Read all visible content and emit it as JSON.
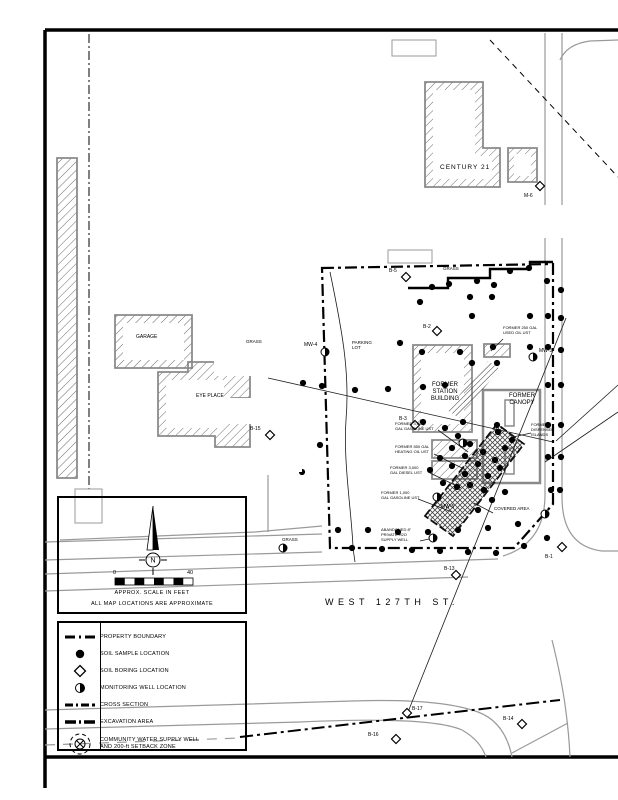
{
  "map": {
    "street_label": "WEST 127TH ST.",
    "labels": [
      {
        "n": "century21-label",
        "t": "CENTURY 21",
        "x": 440,
        "y": 164,
        "fs": 6.5,
        "ls": 1
      },
      {
        "n": "garage-label",
        "t": "GARAGE",
        "x": 136,
        "y": 334,
        "fs": 5
      },
      {
        "n": "grass-label-1",
        "t": "GRASS",
        "x": 246,
        "y": 339,
        "fs": 4.5
      },
      {
        "n": "grass-label-2",
        "t": "GRASS",
        "x": 443,
        "y": 266,
        "fs": 4.5
      },
      {
        "n": "grass-label-3",
        "t": "GRASS",
        "x": 282,
        "y": 537,
        "fs": 4.5
      },
      {
        "n": "parking-lot-label",
        "t": "PARKING\nLOT",
        "x": 352,
        "y": 340,
        "fs": 4.5
      },
      {
        "n": "eyeplace-label",
        "t": "EYE PLACE",
        "x": 196,
        "y": 393,
        "fs": 5
      },
      {
        "n": "former-station-label",
        "t": "FORMER\nSTATION\nBUILDING",
        "x": 423,
        "y": 382,
        "fs": 6,
        "w": 44,
        "ctr": true
      },
      {
        "n": "former-canopy-label",
        "t": "FORMER\nCANOPY",
        "x": 500,
        "y": 393,
        "fs": 6,
        "w": 44,
        "ctr": true
      },
      {
        "n": "dispenser-islands-label",
        "t": "FORMER\nDISPENSER\nISLANDS",
        "x": 531,
        "y": 423,
        "fs": 4
      },
      {
        "n": "ust-3000-gasoline-label",
        "t": "FORMER 3,000\nGAL GASOLINE UST",
        "x": 395,
        "y": 422,
        "fs": 4
      },
      {
        "n": "ust-550-heating-label",
        "t": "FORMER 550 GAL\nHEATING OIL UST",
        "x": 395,
        "y": 445,
        "fs": 4
      },
      {
        "n": "ust-3000-diesel-label",
        "t": "FORMER 3,000\nGAL DIESEL UST",
        "x": 390,
        "y": 466,
        "fs": 4
      },
      {
        "n": "ust-1000-gasoline-label",
        "t": "FORMER 1,000\nGAL GASOLINE UST",
        "x": 381,
        "y": 491,
        "fs": 4
      },
      {
        "n": "ust-250-used-oil-label",
        "t": "FORMER 250 GAL\nUSED OIL UST",
        "x": 503,
        "y": 326,
        "fs": 4
      },
      {
        "n": "abandoned-well-label",
        "t": "ABANDONED 8\"\nPRIVATE H2O\nSUPPLY WELL",
        "x": 381,
        "y": 528,
        "fs": 4
      },
      {
        "n": "covered-area-label",
        "t": "COVERED AREA",
        "x": 494,
        "y": 506,
        "fs": 4.5
      },
      {
        "n": "street-label",
        "t": "WEST 127TH ST.",
        "x": 325,
        "y": 597,
        "fs": 9,
        "ls": 4.5
      }
    ],
    "point_labels": [
      {
        "t": "B-5",
        "x": 389,
        "y": 272
      },
      {
        "t": "M-6",
        "x": 524,
        "y": 197
      },
      {
        "t": "B-15",
        "x": 250,
        "y": 430
      },
      {
        "t": "B-13",
        "x": 444,
        "y": 570
      },
      {
        "t": "B-17",
        "x": 412,
        "y": 710
      },
      {
        "t": "B-16",
        "x": 368,
        "y": 736
      },
      {
        "t": "B-14",
        "x": 503,
        "y": 720
      },
      {
        "t": "MW-4",
        "x": 304,
        "y": 346
      },
      {
        "t": "MW-3",
        "x": 539,
        "y": 352
      },
      {
        "t": "MW-5",
        "x": 441,
        "y": 508
      },
      {
        "t": "B-2",
        "x": 423,
        "y": 328
      },
      {
        "t": "B-3",
        "x": 399,
        "y": 420
      },
      {
        "t": "B-1",
        "x": 545,
        "y": 558
      }
    ],
    "shapes_under": [
      {
        "n": "frame-top",
        "c": "frame",
        "d": "M45,30 L618,30"
      },
      {
        "n": "frame-left",
        "c": "frame",
        "d": "M45,30 L45,788"
      },
      {
        "n": "frame-bottom",
        "c": "frame",
        "d": "M45,757 L618,757"
      },
      {
        "n": "road-vert-west-curb",
        "c": "road",
        "d": "M545,33 L545,495 Q545,543 503,556"
      },
      {
        "n": "road-vert-east-curb",
        "c": "road",
        "d": "M562,33 L562,497 Q562,546 602,551 L618,551"
      },
      {
        "n": "road-127th-north-1",
        "c": "road",
        "d": "M45,574 L498,559"
      },
      {
        "n": "road-127th-north-2",
        "c": "road",
        "d": "M45,591 L468,577"
      },
      {
        "n": "road-127th-slope-1",
        "c": "road",
        "d": "M45,542 L322,534"
      },
      {
        "n": "road-127th-slope-2",
        "c": "road",
        "d": "M45,560 L322,552"
      },
      {
        "n": "road-127th-south-1",
        "c": "road",
        "d": "M45,710 L352,701 Q440,698 478,712 Q505,722 512,757"
      },
      {
        "n": "road-127th-south-2",
        "c": "road",
        "d": "M45,729 L300,722 Q430,716 462,730 Q480,740 486,757"
      },
      {
        "n": "road-side-south",
        "c": "road",
        "d": "M552,640 Q562,680 566,712 Q569,735 570,757"
      },
      {
        "n": "road-island-diag",
        "c": "road",
        "d": "M512,753 L568,723"
      },
      {
        "n": "road-ne-corner",
        "c": "road",
        "d": "M560,60 Q567,44 590,41 L618,40"
      },
      {
        "n": "road-sw-dash",
        "c": "roadd",
        "d": "M45,745 L240,738"
      },
      {
        "n": "grass-edge-curve",
        "c": "road",
        "d": "M60,540 L255,532 Q300,528 322,526"
      },
      {
        "n": "grass-edge-vert",
        "c": "road",
        "d": "M268,475 L268,532"
      },
      {
        "n": "easement-dashdot",
        "c": "dashdot",
        "d": "M89,34 L89,490"
      },
      {
        "n": "topright-dashed-line",
        "c": "topdash",
        "d": "M490,40 L618,177"
      },
      {
        "n": "setback-arc",
        "c": "setback",
        "d": "M240,737 Q420,716 560,700"
      },
      {
        "n": "utility-box-1",
        "c": "graybox",
        "d": "M392,40 h44 v16 h-44 Z"
      },
      {
        "n": "utility-box-2",
        "c": "graybox",
        "d": "M388,250 h44 v13 h-44 Z"
      },
      {
        "n": "utility-box-3",
        "c": "graybox",
        "d": "M75,489 h27 v34 h-27 Z"
      }
    ],
    "polys": [
      {
        "n": "left-strip-building",
        "cls": "hatch",
        "pts": "57,158 77,158 77,478 57,478"
      },
      {
        "n": "century21-building",
        "cls": "hatch",
        "pts": "425,82 483,82 483,148 500,148 500,187 425,187"
      },
      {
        "n": "century21-inner",
        "cls": "white",
        "pts": "433,90 475,90 475,156 492,156 492,179 433,179"
      },
      {
        "n": "century21-annex",
        "cls": "hatch",
        "pts": "508,148 537,148 537,182 508,182"
      },
      {
        "n": "century21-annex-inner",
        "cls": "white",
        "pts": "514,154 531,154 531,176 514,176"
      },
      {
        "n": "garage-building",
        "cls": "hatch",
        "pts": "115,315 192,315 192,368 115,368"
      },
      {
        "n": "garage-inner",
        "cls": "white",
        "pts": "123,323 184,323 184,360 123,360"
      },
      {
        "n": "eyeplace-building",
        "cls": "hatch",
        "pts": "158,372 188,372 188,362 250,362 250,398 232,398 232,420 250,420 250,447 215,447 215,436 158,436"
      },
      {
        "n": "eyeplace-inner",
        "cls": "white",
        "pts": "166,380 224,380 224,428 166,428"
      },
      {
        "n": "station-building",
        "cls": "hatch",
        "pts": "413,345 472,345 472,432 413,432"
      },
      {
        "n": "station-inner",
        "cls": "white",
        "pts": "421,353 464,353 464,424 421,424"
      },
      {
        "n": "former-canopy-outline",
        "cls": "canopy",
        "pts": "483,390 540,390 540,483 483,483"
      },
      {
        "n": "dispenser-island-1",
        "cls": "pill",
        "pts": "505,400 514,400 514,426 505,426"
      },
      {
        "n": "dispenser-island-2",
        "cls": "pill",
        "pts": "505,448 514,448 514,474 505,474"
      },
      {
        "n": "ne-hatch-strip",
        "cls": "hatch2",
        "pts": "447,410 488,361 500,369 459,418"
      },
      {
        "n": "tank-basin-1",
        "cls": "hatch",
        "pts": "432,440 477,440 477,458 432,458"
      },
      {
        "n": "tank-basin-2",
        "cls": "hatch",
        "pts": "432,461 477,461 477,479 432,479"
      },
      {
        "n": "tank-basin-3",
        "cls": "hatch",
        "pts": "484,344 510,344 510,357 484,357"
      },
      {
        "n": "excavation-area",
        "cls": "xhatch",
        "pts": "425,516 497,424 524,444 453,536"
      }
    ],
    "shapes_over": [
      {
        "n": "property-boundary",
        "c": "boundary",
        "d": "M322,268 L553,264 L553,504 L514,548 L330,548 Z"
      },
      {
        "n": "north-step-wall",
        "c": "bold",
        "d": "M408,288 L448,288 L448,278 L490,278 L490,269 L530,269 L530,262 L553,262"
      },
      {
        "n": "section-line-to-b17",
        "c": "thin",
        "d": "M566,318 L408,712"
      },
      {
        "n": "offsite-leader-1",
        "c": "thin",
        "d": "M618,385 L556,441"
      },
      {
        "n": "offsite-leader-2",
        "c": "thin",
        "d": "M618,412 L545,462"
      },
      {
        "n": "cross-site-line",
        "c": "thin",
        "d": "M268,378 L553,442"
      },
      {
        "n": "west-curb-curve",
        "c": "thin",
        "d": "M330,272 C342,330 350,372 346,420 C343,462 352,515 353,548 L355,562"
      },
      {
        "n": "leader-ust-gasoline",
        "c": "thin",
        "d": "M438,430 L468,452"
      },
      {
        "n": "leader-ust-heating",
        "c": "thin",
        "d": "M434,454 L466,470"
      },
      {
        "n": "leader-ust-diesel",
        "c": "thin",
        "d": "M430,473 L461,488"
      },
      {
        "n": "leader-ust-1000",
        "c": "thin",
        "d": "M418,499 L452,512"
      },
      {
        "n": "leader-ust-250",
        "c": "thin",
        "d": "M503,339 L491,351"
      },
      {
        "n": "leader-abandoned-well",
        "c": "thin",
        "d": "M420,541 L429,539"
      },
      {
        "n": "leader-dispenser",
        "c": "thin",
        "d": "M531,433 L513,437"
      },
      {
        "n": "leader-covered-area",
        "c": "thin",
        "d": "M493,513 L474,503"
      }
    ],
    "points": {
      "samples": [
        [
          432,
          287
        ],
        [
          449,
          284
        ],
        [
          477,
          281
        ],
        [
          494,
          285
        ],
        [
          510,
          271
        ],
        [
          529,
          268
        ],
        [
          547,
          281
        ],
        [
          420,
          302
        ],
        [
          470,
          297
        ],
        [
          492,
          297
        ],
        [
          472,
          316
        ],
        [
          530,
          316
        ],
        [
          548,
          316
        ],
        [
          400,
          343
        ],
        [
          493,
          347
        ],
        [
          530,
          347
        ],
        [
          548,
          347
        ],
        [
          561,
          290
        ],
        [
          561,
          318
        ],
        [
          561,
          350
        ],
        [
          561,
          385
        ],
        [
          561,
          425
        ],
        [
          561,
          457
        ],
        [
          560,
          490
        ],
        [
          303,
          383
        ],
        [
          322,
          386
        ],
        [
          355,
          390
        ],
        [
          388,
          389
        ],
        [
          423,
          387
        ],
        [
          445,
          385
        ],
        [
          472,
          363
        ],
        [
          497,
          363
        ],
        [
          422,
          352
        ],
        [
          460,
          352
        ],
        [
          423,
          422
        ],
        [
          463,
          422
        ],
        [
          320,
          445
        ],
        [
          302,
          472
        ],
        [
          445,
          428
        ],
        [
          458,
          436
        ],
        [
          470,
          444
        ],
        [
          483,
          452
        ],
        [
          495,
          460
        ],
        [
          452,
          448
        ],
        [
          465,
          456
        ],
        [
          478,
          464
        ],
        [
          440,
          458
        ],
        [
          452,
          466
        ],
        [
          465,
          474
        ],
        [
          488,
          476
        ],
        [
          500,
          468
        ],
        [
          505,
          448
        ],
        [
          512,
          440
        ],
        [
          498,
          432
        ],
        [
          470,
          485
        ],
        [
          484,
          490
        ],
        [
          457,
          487
        ],
        [
          443,
          483
        ],
        [
          430,
          470
        ],
        [
          497,
          425
        ],
        [
          548,
          385
        ],
        [
          548,
          425
        ],
        [
          548,
          457
        ],
        [
          551,
          490
        ],
        [
          492,
          500
        ],
        [
          478,
          510
        ],
        [
          505,
          492
        ],
        [
          338,
          530
        ],
        [
          368,
          530
        ],
        [
          398,
          532
        ],
        [
          428,
          532
        ],
        [
          458,
          530
        ],
        [
          488,
          528
        ],
        [
          518,
          524
        ],
        [
          352,
          548
        ],
        [
          382,
          549
        ],
        [
          412,
          550
        ],
        [
          440,
          551
        ],
        [
          468,
          552
        ],
        [
          496,
          553
        ],
        [
          524,
          546
        ],
        [
          547,
          538
        ]
      ],
      "borings": [
        [
          406,
          277
        ],
        [
          437,
          331
        ],
        [
          415,
          425
        ],
        [
          270,
          435
        ],
        [
          540,
          186
        ],
        [
          562,
          547
        ],
        [
          456,
          575
        ],
        [
          407,
          713
        ],
        [
          396,
          739
        ],
        [
          522,
          724
        ]
      ],
      "wells": [
        [
          325,
          352
        ],
        [
          533,
          357
        ],
        [
          463,
          443
        ],
        [
          437,
          497
        ],
        [
          283,
          548
        ],
        [
          545,
          514
        ],
        [
          433,
          538
        ]
      ]
    },
    "redactions": [
      [
        488,
        205,
        130,
        33
      ],
      [
        571,
        300,
        47,
        42
      ],
      [
        214,
        350,
        88,
        26
      ],
      [
        214,
        398,
        88,
        26
      ],
      [
        222,
        450,
        80,
        22
      ]
    ]
  },
  "scale_box": {
    "north_letter": "N",
    "tick_start": "0",
    "tick_end": "40",
    "caption": "APPROX. SCALE IN FEET",
    "note": "ALL MAP LOCATIONS ARE APPROXIMATE"
  },
  "legend": {
    "items": [
      {
        "symbol": "property-boundary",
        "label": "PROPERTY BOUNDARY"
      },
      {
        "symbol": "soil-sample",
        "label": "SOIL SAMPLE LOCATION"
      },
      {
        "symbol": "soil-boring",
        "label": "SOIL BORING LOCATION"
      },
      {
        "symbol": "monitoring-well",
        "label": "MONITORING WELL LOCATION"
      },
      {
        "symbol": "cross-section",
        "label": "CROSS SECTION"
      },
      {
        "symbol": "excavation-area",
        "label": "EXCAVATION AREA"
      },
      {
        "symbol": "community-well",
        "label": "COMMUNITY WATER SUPPLY WELL\nAND 200-ft SETBACK ZONE"
      }
    ]
  }
}
